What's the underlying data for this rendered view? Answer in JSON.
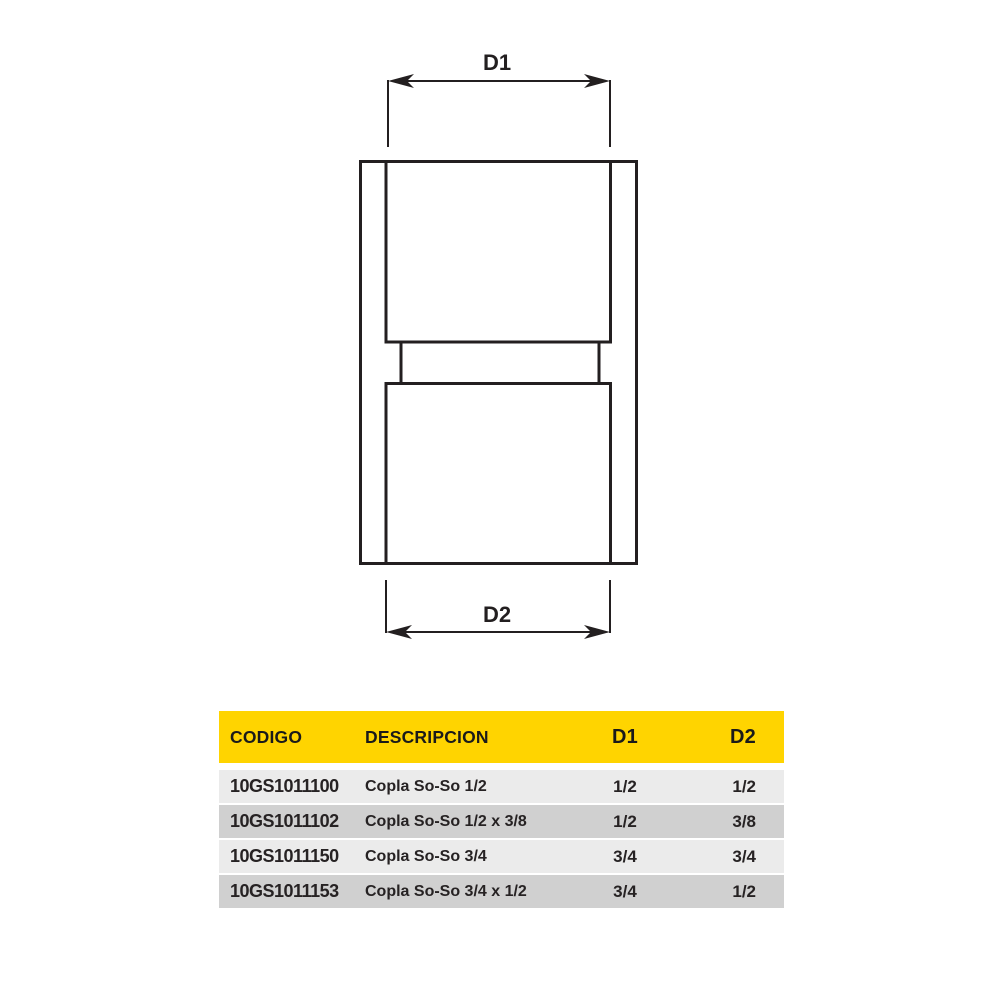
{
  "diagram": {
    "d1_label": "D1",
    "d2_label": "D2"
  },
  "table": {
    "headers": {
      "codigo": "CODIGO",
      "descripcion": "DESCRIPCION",
      "d1": "D1",
      "d2": "D2"
    },
    "rows": [
      {
        "codigo": "10GS1011100",
        "descripcion": "Copla So-So 1/2",
        "d1": "1/2",
        "d2": "1/2"
      },
      {
        "codigo": "10GS1011102",
        "descripcion": "Copla So-So 1/2 x 3/8",
        "d1": "1/2",
        "d2": "3/8"
      },
      {
        "codigo": "10GS1011150",
        "descripcion": "Copla So-So 3/4",
        "d1": "3/4",
        "d2": "3/4"
      },
      {
        "codigo": "10GS1011153",
        "descripcion": "Copla So-So 3/4 x 1/2",
        "d1": "3/4",
        "d2": "1/2"
      }
    ],
    "colors": {
      "header_bg": "#FFD400",
      "header_text": "#1A1A1A",
      "row_light": "#EBEBEB",
      "row_dark": "#D0D0D0",
      "text": "#262223",
      "line": "#231F20"
    }
  }
}
